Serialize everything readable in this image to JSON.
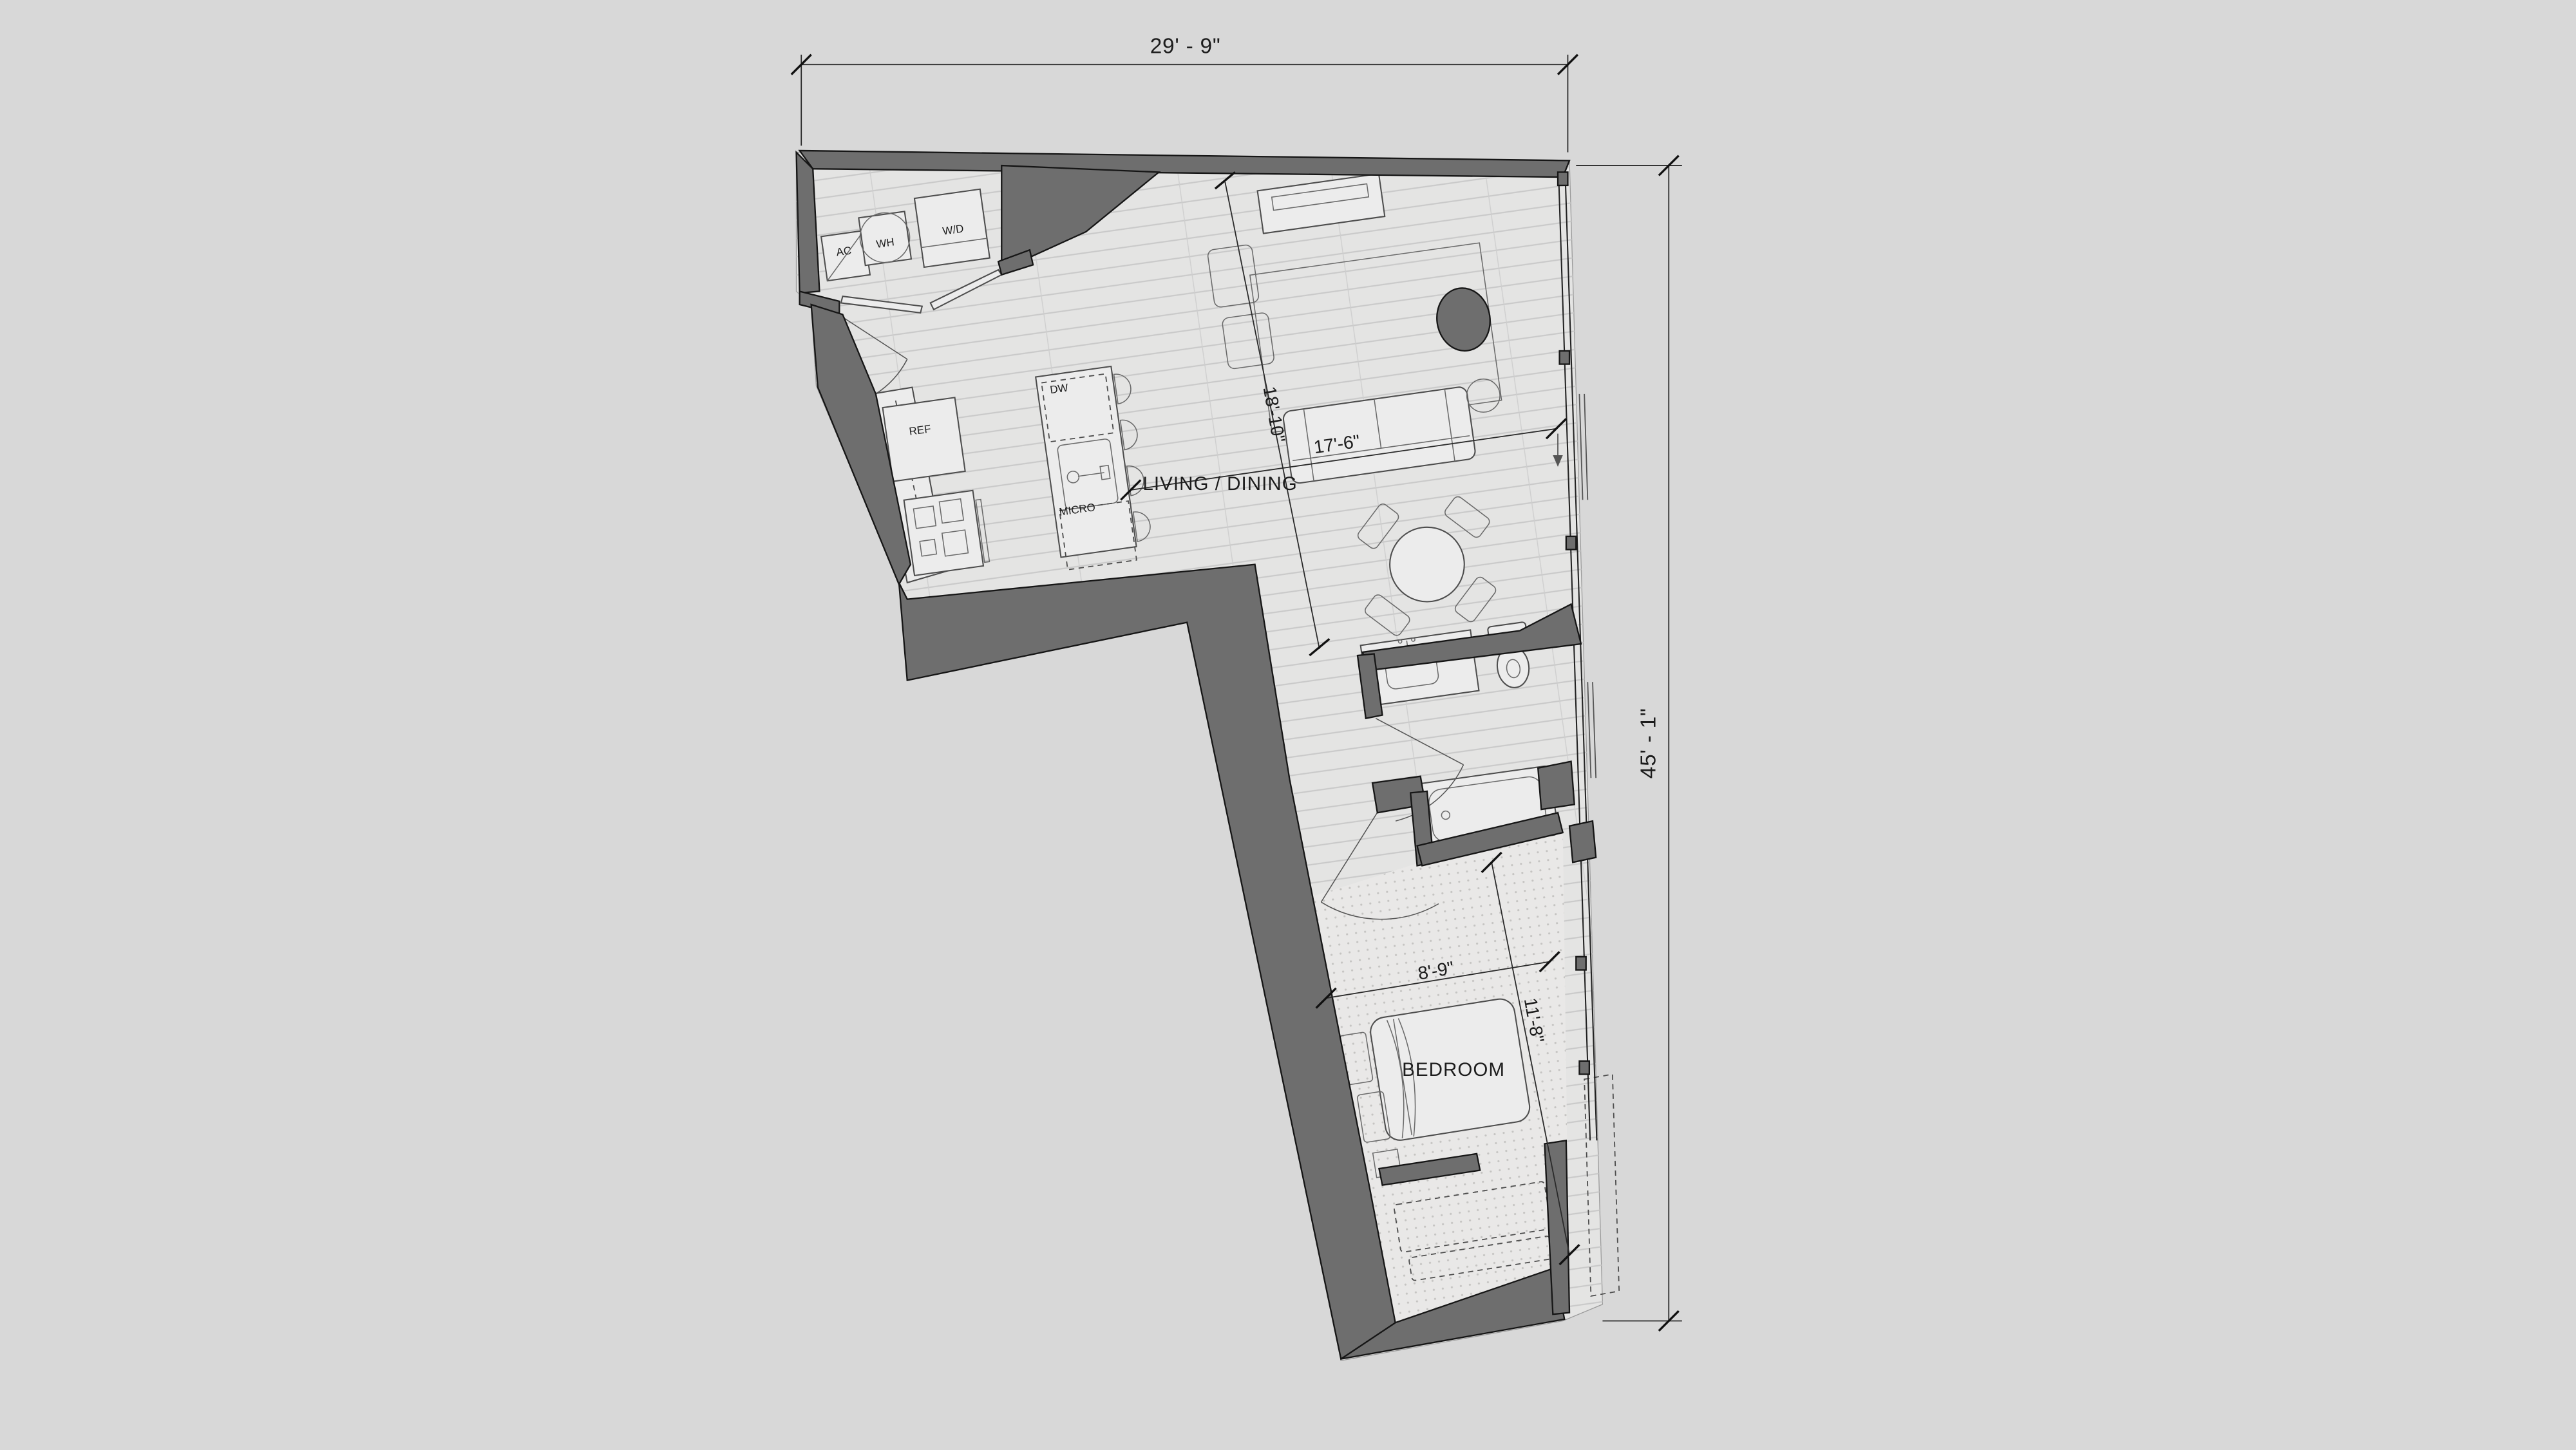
{
  "drawing": {
    "type": "apartment floor plan",
    "rooms": {
      "living": "LIVING / DINING",
      "bedroom": "BEDROOM"
    },
    "appliances": {
      "ac": "AC",
      "wh": "WH",
      "wd": "W/D",
      "ref": "REF",
      "dw": "DW",
      "micro": "MICRO"
    },
    "dimensions": {
      "overall_width": "29' - 9\"",
      "overall_height": "45' - 1\"",
      "living_length": "18'-10\"",
      "living_width": "17'-6\"",
      "bedroom_width": "8'-9\"",
      "bedroom_length": "11'-8\""
    },
    "colors": {
      "background": "#d8d8d8",
      "floor": "#e4e4e3",
      "wall": "#6e6e6e",
      "carpet": "#e9e8e7",
      "line": "#1c1c1c"
    }
  }
}
